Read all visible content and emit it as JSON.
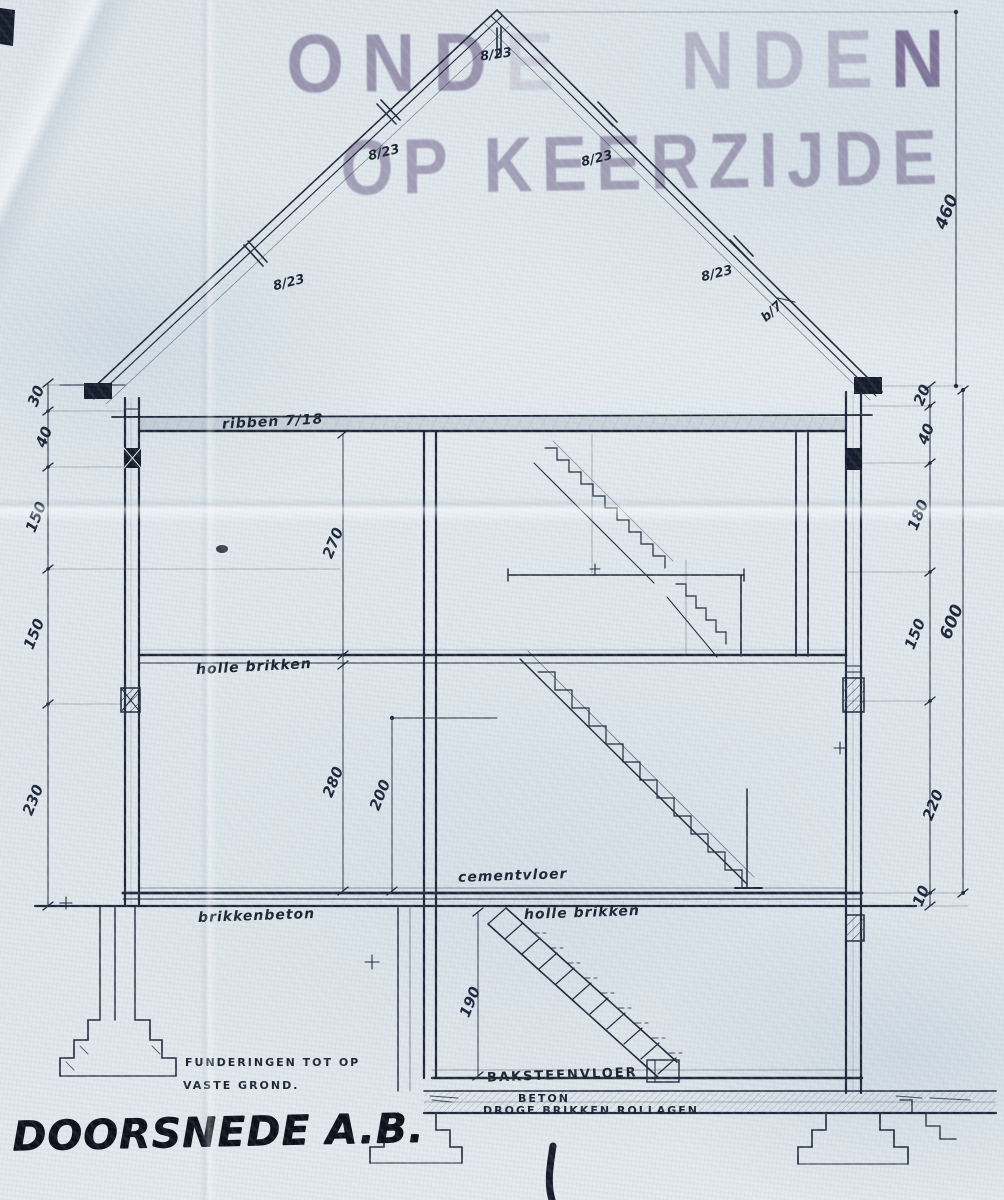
{
  "stamp": {
    "line1_left": "OND",
    "line1_mid": "E",
    "line1_right_a": "NDE",
    "line1_right_b": "N",
    "line2": "OP KEERZIJDE"
  },
  "roof": {
    "rafter_labels": [
      "8/23",
      "8/23",
      "8/23",
      "8/23",
      "8/23"
    ],
    "batten_label": "b/7"
  },
  "dims": {
    "roof_height": "460",
    "right": {
      "top": "20",
      "eave": "40",
      "attic": "180",
      "first": "150",
      "total": "600",
      "ground": "220",
      "plinth": "10"
    },
    "left": {
      "top": "30",
      "eave": "40",
      "attic": "150",
      "first": "150",
      "ground": "230"
    },
    "interior": {
      "attic": "270",
      "ground": "280",
      "clear": "200",
      "basement": "190"
    }
  },
  "labels": {
    "ribs": "ribben 7/18",
    "hollow_bricks_upper": "holle brikken",
    "cement_floor": "cementvloer",
    "brick_concrete": "brikkenbeton",
    "hollow_bricks_lower": "holle brikken",
    "brick_floor": "BAKSTEENVLOER",
    "concrete": "BETON",
    "dry_bricks": "DROGE BRIKKEN ROLLAGEN.",
    "foundation_line1": "FUNDERINGEN TOT OP",
    "foundation_line2": "VASTE GROND."
  },
  "title": "DOORSNEDE A.B.",
  "colors": {
    "paper": "#e1e8ed",
    "ink": "#15202f",
    "pencil": "#3c4c68",
    "stamp": "#5c4a78"
  }
}
